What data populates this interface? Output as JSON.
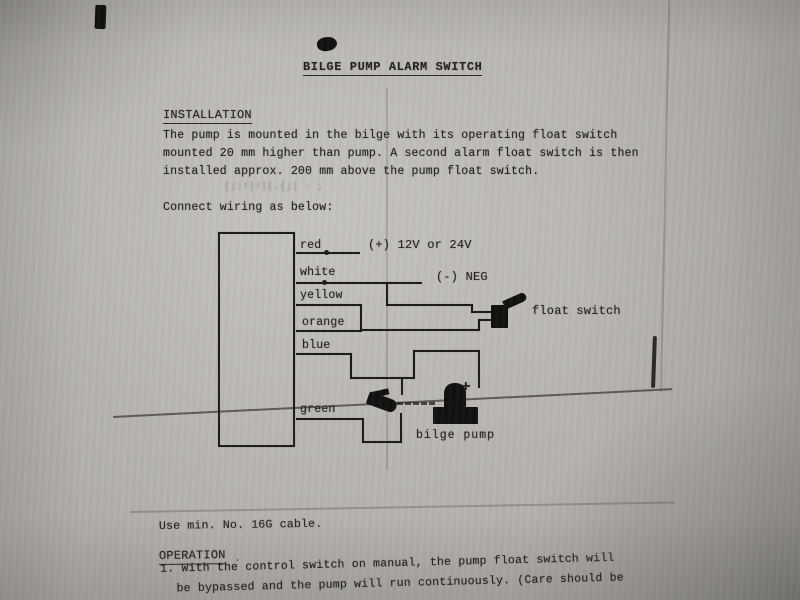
{
  "document": {
    "title": "BILGE PUMP ALARM SWITCH",
    "installation": {
      "heading": "INSTALLATION",
      "line1": "The pump is mounted in the bilge with its operating float switch",
      "line2": "mounted 20 mm higher than pump. A second alarm float switch is then",
      "line3": "installed approx. 200 mm above the pump float switch.",
      "ghost_text": "(;:!|!|(.{;| : ;",
      "connect_note": "Connect wiring as below:"
    },
    "diagram": {
      "wires": {
        "red": "red",
        "white": "white",
        "yellow": "yellow",
        "orange": "orange",
        "blue": "blue",
        "green": "green"
      },
      "positive_terminal": "(+) 12V or 24V",
      "negative_terminal": "(-) NEG",
      "float_switch": "float switch",
      "pump_positive": "+",
      "bilge_pump": "bilge pump"
    },
    "cable_note": "Use min. No. 16G cable.",
    "operation": {
      "heading": "OPERATION",
      "period": ".",
      "item_line1": "1. With the control switch on manual, the pump float switch will",
      "item_line2": "be bypassed and the pump will run continuously. (Care should be"
    }
  },
  "colors": {
    "paper": "#b2afaa",
    "ink": "#262422"
  }
}
